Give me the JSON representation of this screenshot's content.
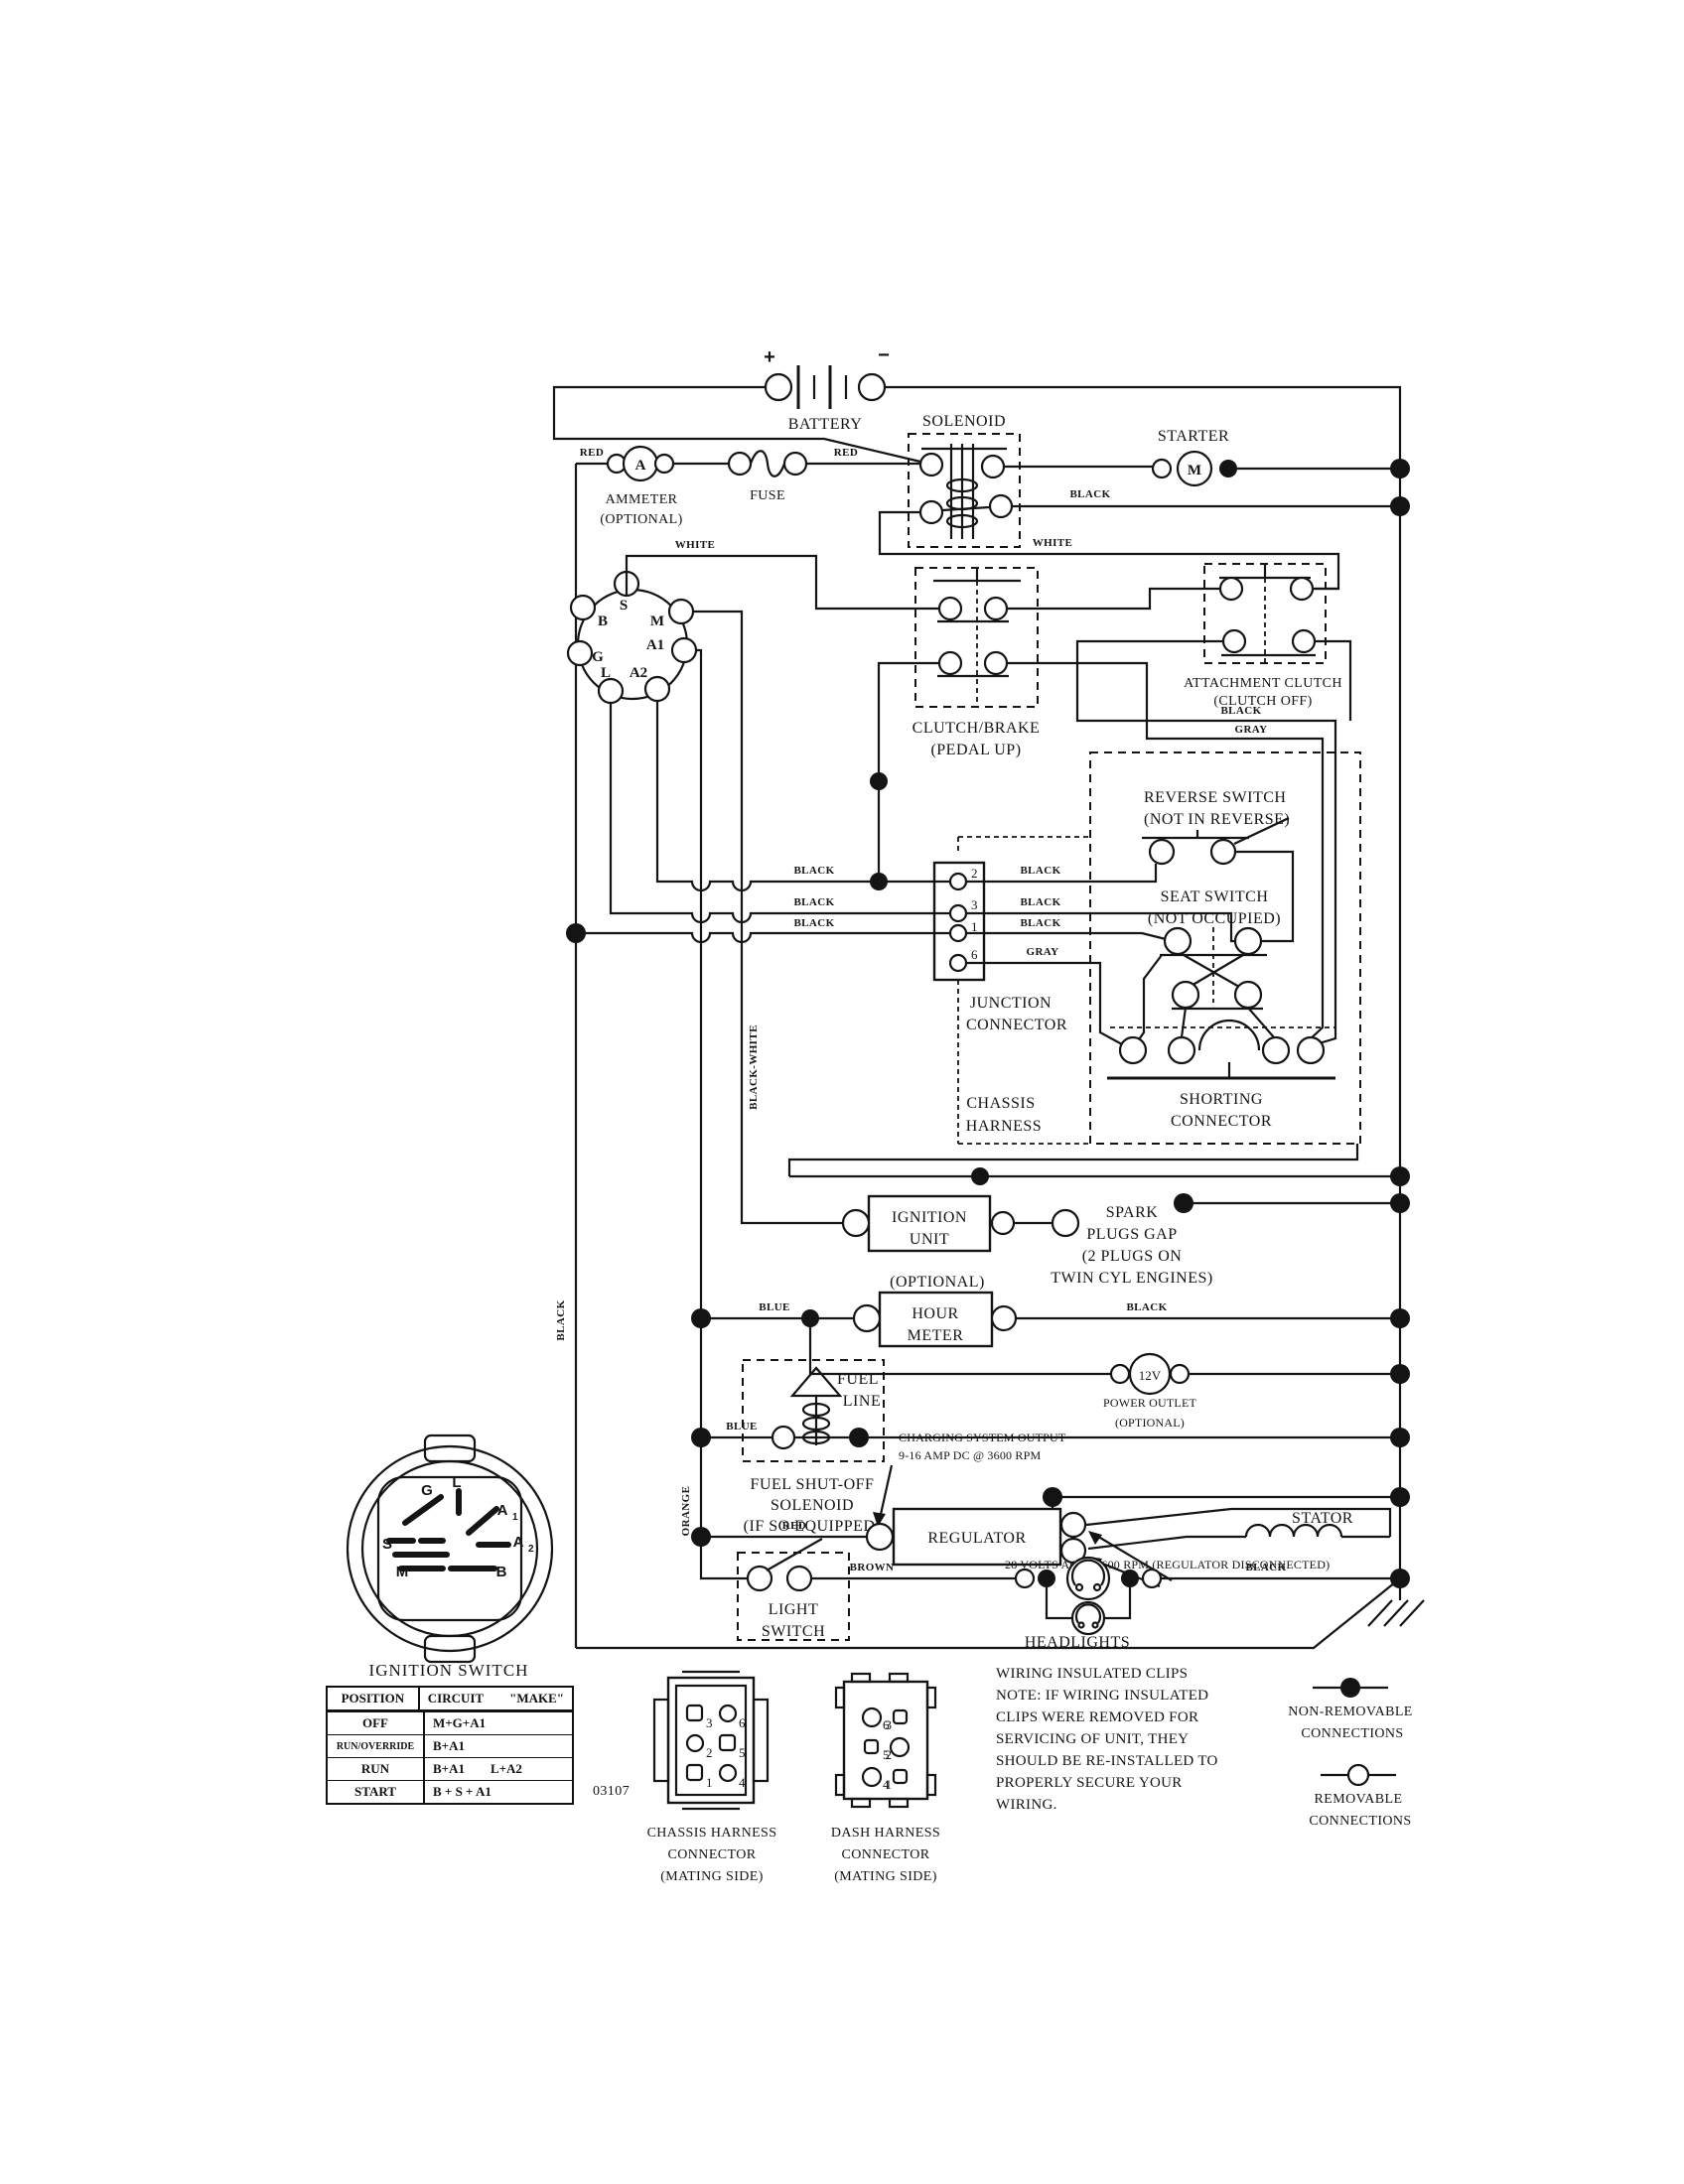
{
  "wire_colors": {
    "red": "RED",
    "black": "BLACK",
    "white": "WHITE",
    "gray": "GRAY",
    "blue": "BLUE",
    "brown": "BROWN",
    "orange": "ORANGE",
    "black_white": "BLACK-WHITE"
  },
  "components": {
    "battery": "BATTERY",
    "battery_plus": "+",
    "battery_minus": "−",
    "solenoid": "SOLENOID",
    "starter": "STARTER",
    "starter_symbol": "M",
    "fuse": "FUSE",
    "ammeter_symbol": "A",
    "ammeter_line1": "AMMETER",
    "ammeter_line2": "(OPTIONAL)",
    "clutch_brake_line1": "CLUTCH/BRAKE",
    "clutch_brake_line2": "(PEDAL UP)",
    "attachment_line1": "ATTACHMENT CLUTCH",
    "attachment_line2": "(CLUTCH OFF)",
    "reverse_line1": "REVERSE SWITCH",
    "reverse_line2": "(NOT IN REVERSE)",
    "seat_line1": "SEAT SWITCH",
    "seat_line2": "(NOT OCCUPIED)",
    "junction_line1": "JUNCTION",
    "junction_line2": "CONNECTOR",
    "shorting_line1": "SHORTING",
    "shorting_line2": "CONNECTOR",
    "chassis_line1": "CHASSIS",
    "chassis_line2": "HARNESS",
    "ignition_unit_line1": "IGNITION",
    "ignition_unit_line2": "UNIT",
    "spark_line1": "SPARK",
    "spark_line2": "PLUGS GAP",
    "spark_line3": "(2 PLUGS ON",
    "spark_line4": "TWIN CYL  ENGINES)",
    "hour_optional": "(OPTIONAL)",
    "hour_line1": "HOUR",
    "hour_line2": "METER",
    "fuel_line1": "FUEL",
    "fuel_line2": "LINE",
    "fuel_sol_line1": "FUEL SHUT-OFF",
    "fuel_sol_line2": "SOLENOID",
    "fuel_sol_line3": "(IF SO EQUIPPED)",
    "power_value": "12V",
    "power_line1": "POWER OUTLET",
    "power_line2": "(OPTIONAL)",
    "charging_line1": "CHARGING SYSTEM OUTPUT",
    "charging_line2": "9-16 AMP DC @ 3600 RPM",
    "regulator": "REGULATOR",
    "stator": "STATOR",
    "volts_note": "28 VOLTS AC @ 3600 RPM (REGULATOR DISCONNECTED)",
    "light_line1": "LIGHT",
    "light_line2": "SWITCH",
    "headlights": "HEADLIGHTS"
  },
  "ignition_connector": {
    "b": "B",
    "s": "S",
    "m": "M",
    "g": "G",
    "a1": "A1",
    "a2": "A2",
    "l": "L"
  },
  "junction_pins": [
    "2",
    "3",
    "1",
    "6"
  ],
  "switch_face": {
    "title": "IGNITION SWITCH",
    "g": "G",
    "l": "L",
    "s": "S",
    "m": "M",
    "b": "B",
    "a1": "A",
    "a1_sub": "1",
    "a2": "A",
    "a2_sub": "2"
  },
  "ignition_table": {
    "col_position": "POSITION",
    "col_circuit": "CIRCUIT",
    "col_make": "\"MAKE\"",
    "rows": [
      {
        "position": "OFF",
        "make1": "M+G+A1",
        "make2": ""
      },
      {
        "position": "RUN/OVERRIDE",
        "make1": "B+A1",
        "make2": ""
      },
      {
        "position": "RUN",
        "make1": "B+A1",
        "make2": "L+A2"
      },
      {
        "position": "START",
        "make1": "B + S + A1",
        "make2": ""
      }
    ]
  },
  "drawing_number": "03107",
  "connectors": {
    "chassis": {
      "line1": "CHASSIS HARNESS",
      "line2": "CONNECTOR",
      "line3": "(MATING SIDE)",
      "pins": [
        "3",
        "6",
        "2",
        "5",
        "1",
        "4"
      ]
    },
    "dash": {
      "line1": "DASH HARNESS",
      "line2": "CONNECTOR",
      "line3": "(MATING SIDE)",
      "pins": [
        "6",
        "3",
        "5",
        "2",
        "4",
        "1"
      ]
    }
  },
  "note": {
    "lines": [
      "WIRING INSULATED CLIPS",
      "NOTE:  IF WIRING INSULATED",
      "CLIPS WERE REMOVED FOR",
      "SERVICING OF UNIT, THEY",
      "SHOULD BE RE-INSTALLED TO",
      "PROPERLY SECURE YOUR",
      " WIRING."
    ]
  },
  "legend": {
    "non_removable_line1": "NON-REMOVABLE",
    "non_removable_line2": "CONNECTIONS",
    "removable_line1": "REMOVABLE",
    "removable_line2": "CONNECTIONS"
  }
}
